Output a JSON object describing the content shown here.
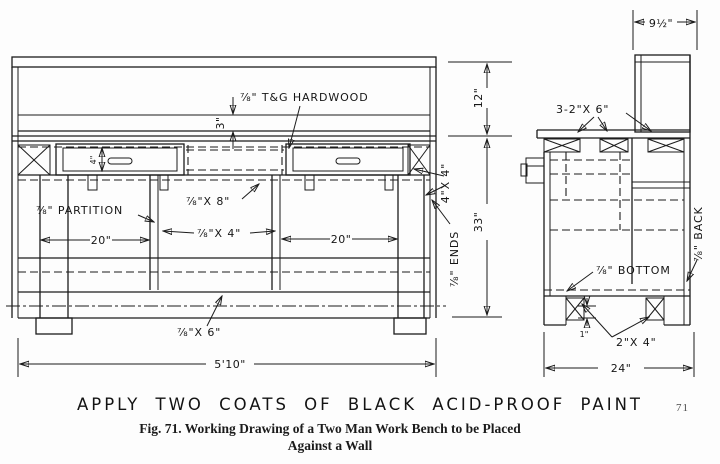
{
  "page": {
    "paint_note": "APPLY TWO COATS OF BLACK ACID-PROOF PAINT",
    "caption_line1": "Fig. 71.   Working Drawing of a Two Man Work Bench to be Placed",
    "caption_line2": "Against a Wall",
    "page_number": "71"
  },
  "front_view": {
    "dim_top_edge": "3\"",
    "dim_drawer_front": "4\"",
    "dim_backboard": "12\"",
    "dim_height": "33\"",
    "dim_bay_left": "20\"",
    "dim_bay_right": "20\"",
    "dim_overall_width": "5'10\"",
    "label_top": "⅞\" T&G HARDWOOD",
    "label_partition": "⅞\" PARTITION",
    "label_rail8": "⅞\"X 8\"",
    "label_rail4": "⅞\"X 4\"",
    "label_posts": "4\"X 4\"",
    "label_ends": "⅞\" ENDS",
    "label_bottom_rail": "⅞\"X 6\""
  },
  "side_view": {
    "dim_shelf_depth": "9½\"",
    "dim_depth": "24\"",
    "dim_runner": "1\"",
    "label_top_frame": "3-2\"X 6\"",
    "label_bottom": "⅞\" BOTTOM",
    "label_back": "⅞\" BACK",
    "label_runners": "2\"X 4\""
  }
}
